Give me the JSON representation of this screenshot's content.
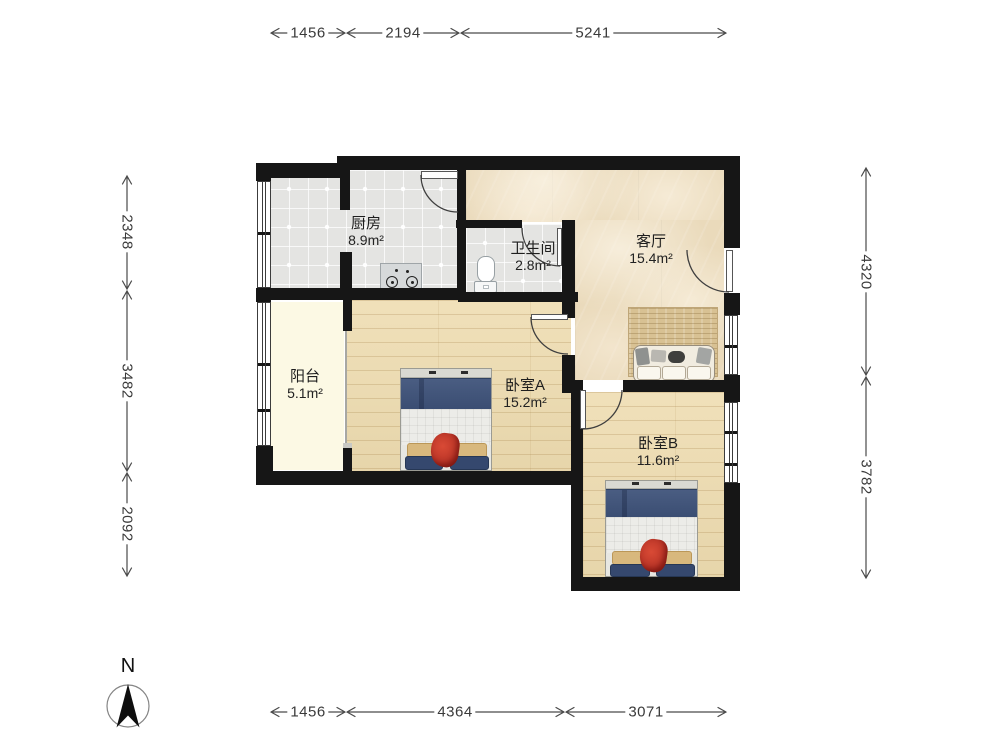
{
  "title": "两室一厅户型图",
  "compass": {
    "north_label": "N"
  },
  "rooms": {
    "kitchen": {
      "name": "厨房",
      "area": "8.9m²"
    },
    "bathroom": {
      "name": "卫生间",
      "area": "2.8m²"
    },
    "living": {
      "name": "客厅",
      "area": "15.4m²"
    },
    "balcony": {
      "name": "阳台",
      "area": "5.1m²"
    },
    "bedroomA": {
      "name": "卧室A",
      "area": "15.2m²"
    },
    "bedroomB": {
      "name": "卧室B",
      "area": "11.6m²"
    }
  },
  "dimensions": {
    "top": [
      "1456",
      "2194",
      "5241"
    ],
    "bottom": [
      "1456",
      "4364",
      "3071"
    ],
    "left": [
      "2348",
      "3482",
      "2092"
    ],
    "right": [
      "4320",
      "3782"
    ]
  },
  "colors": {
    "wall": "#161616",
    "tile_floor": "#e4e4e2",
    "marble_floor": "#eadabb",
    "wood_floor": "#eedcb0",
    "balcony_floor": "#fcf9e4",
    "blanket_navy": "#41547a",
    "pillow_khaki": "#d8b87d",
    "cloth_red": "#c0392b"
  }
}
